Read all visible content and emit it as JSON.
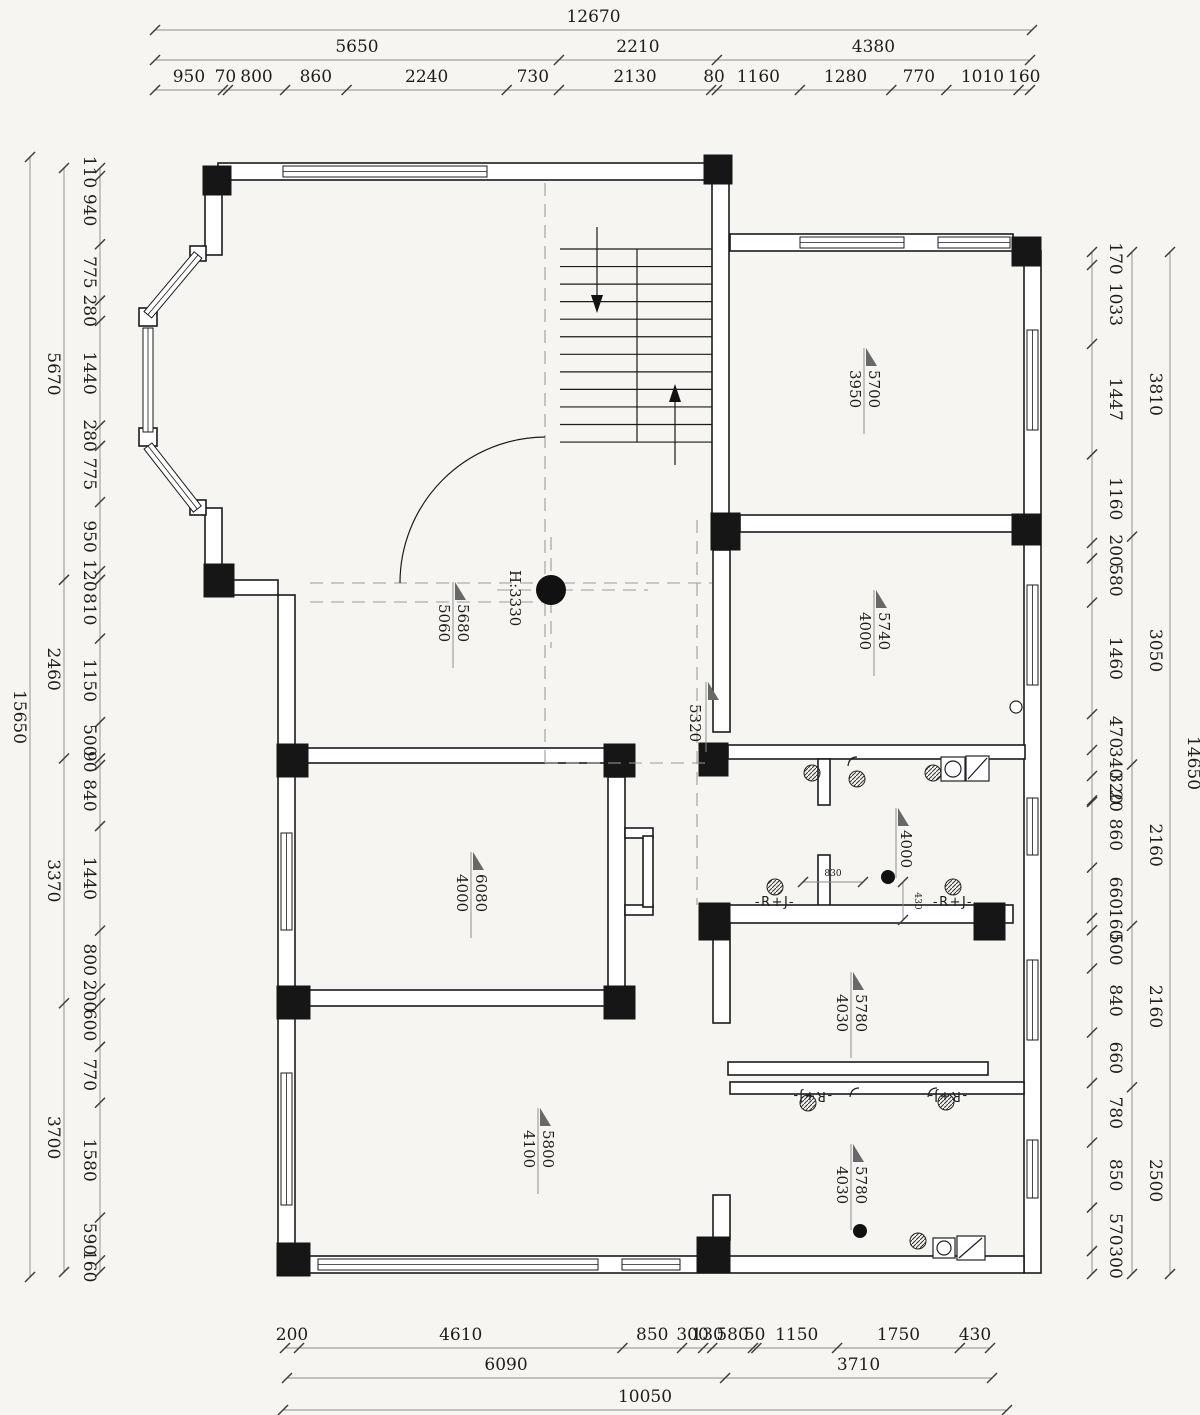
{
  "page": {
    "background": "#f6f5f1",
    "line_color": "#1b1b1b",
    "dash_color": "#9c9c9c",
    "flag_color": "#686868"
  },
  "plan": {
    "labels": {
      "room_top_right": {
        "v1": "5700",
        "v2": "3950"
      },
      "room_mid_right": {
        "v1": "5740",
        "v2": "4000"
      },
      "hall": {
        "v1": "5680",
        "v2": "5060"
      },
      "ceiling_height": "H:3330",
      "corridor": "5320",
      "room_mid_left": {
        "v1": "6080",
        "v2": "4000"
      },
      "bath": "4000",
      "room_right_1": {
        "v1": "5780",
        "v2": "4030"
      },
      "room_bottom_left": {
        "v1": "5800",
        "v2": "4100"
      },
      "room_right_2": {
        "v1": "5780",
        "v2": "4030"
      },
      "rj_marker": "-R+J-"
    }
  },
  "dims": {
    "rows": [
      {
        "id": "top-outer",
        "axis": "h",
        "line": 30,
        "text": 22,
        "start": 155,
        "end": 1032,
        "labels": [
          "12670"
        ]
      },
      {
        "id": "top-mid",
        "axis": "h",
        "line": 60,
        "text": 52,
        "start": 155,
        "end": 1030,
        "labels": [
          "5650",
          "2210",
          "4380"
        ]
      },
      {
        "id": "top-detail",
        "axis": "h",
        "line": 90,
        "text": 82,
        "start": 155,
        "end": 1030,
        "labels": [
          "950",
          "70",
          "800",
          "860",
          "2240",
          "730",
          "2130",
          "80",
          "1160",
          "1280",
          "770",
          "1010",
          "160"
        ]
      },
      {
        "id": "bottom-detail",
        "axis": "h",
        "line": 1348,
        "text": 1340,
        "start": 285,
        "end": 990,
        "labels": [
          "200",
          "4610",
          "850",
          "300",
          "130",
          "580",
          "50",
          "1150",
          "1750",
          "430"
        ]
      },
      {
        "id": "bottom-mid",
        "axis": "h",
        "line": 1378,
        "text": 1370,
        "start": 287,
        "end": 992,
        "labels": [
          "6090",
          "3710"
        ]
      },
      {
        "id": "bottom-outer",
        "axis": "h",
        "line": 1410,
        "text": 1402,
        "start": 283,
        "end": 1007,
        "labels": [
          "10050"
        ]
      },
      {
        "id": "left-outer",
        "axis": "v",
        "line": 30,
        "text": 14,
        "start": 157,
        "end": 1277,
        "labels": [
          "15650"
        ]
      },
      {
        "id": "left-mid",
        "axis": "v",
        "line": 64,
        "text": 48,
        "start": 168,
        "end": 1272,
        "labels": [
          "5670",
          "2460",
          "3370",
          "3700"
        ]
      },
      {
        "id": "left-detail",
        "axis": "v",
        "line": 100,
        "text": 84,
        "start": 168,
        "end": 1272,
        "labels": [
          "110",
          "940",
          "775",
          "280",
          "1440",
          "280",
          "775",
          "950",
          "120",
          "810",
          "1150",
          "500",
          "90",
          "840",
          "1440",
          "800",
          "200",
          "600",
          "770",
          "1580",
          "590",
          "160"
        ]
      },
      {
        "id": "right-detail",
        "axis": "v",
        "line": 1092,
        "text": 1110,
        "start": 252,
        "end": 1274,
        "labels": [
          "170",
          "1033",
          "1447",
          "1160",
          "200",
          "580",
          "1460",
          "470",
          "340",
          "320",
          "20",
          "860",
          "660",
          "160",
          "500",
          "840",
          "660",
          "780",
          "850",
          "570",
          "300"
        ]
      },
      {
        "id": "right-mid",
        "axis": "v",
        "line": 1132,
        "text": 1150,
        "start": 252,
        "end": 1274,
        "labels": [
          "3810",
          "3050",
          "2160",
          "2160",
          "2500"
        ]
      },
      {
        "id": "right-outer",
        "axis": "v",
        "line": 1170,
        "text": 1188,
        "start": 252,
        "end": 1274,
        "labels": [
          "14650"
        ]
      },
      {
        "id": "bath-830",
        "axis": "h",
        "line": 882,
        "text": 876,
        "start": 803,
        "end": 863,
        "labels": [
          "830"
        ],
        "fs": 9
      },
      {
        "id": "bath-430",
        "axis": "v",
        "line": 903,
        "text": 915,
        "start": 882,
        "end": 920,
        "labels": [
          "430"
        ],
        "fs": 9
      }
    ]
  }
}
